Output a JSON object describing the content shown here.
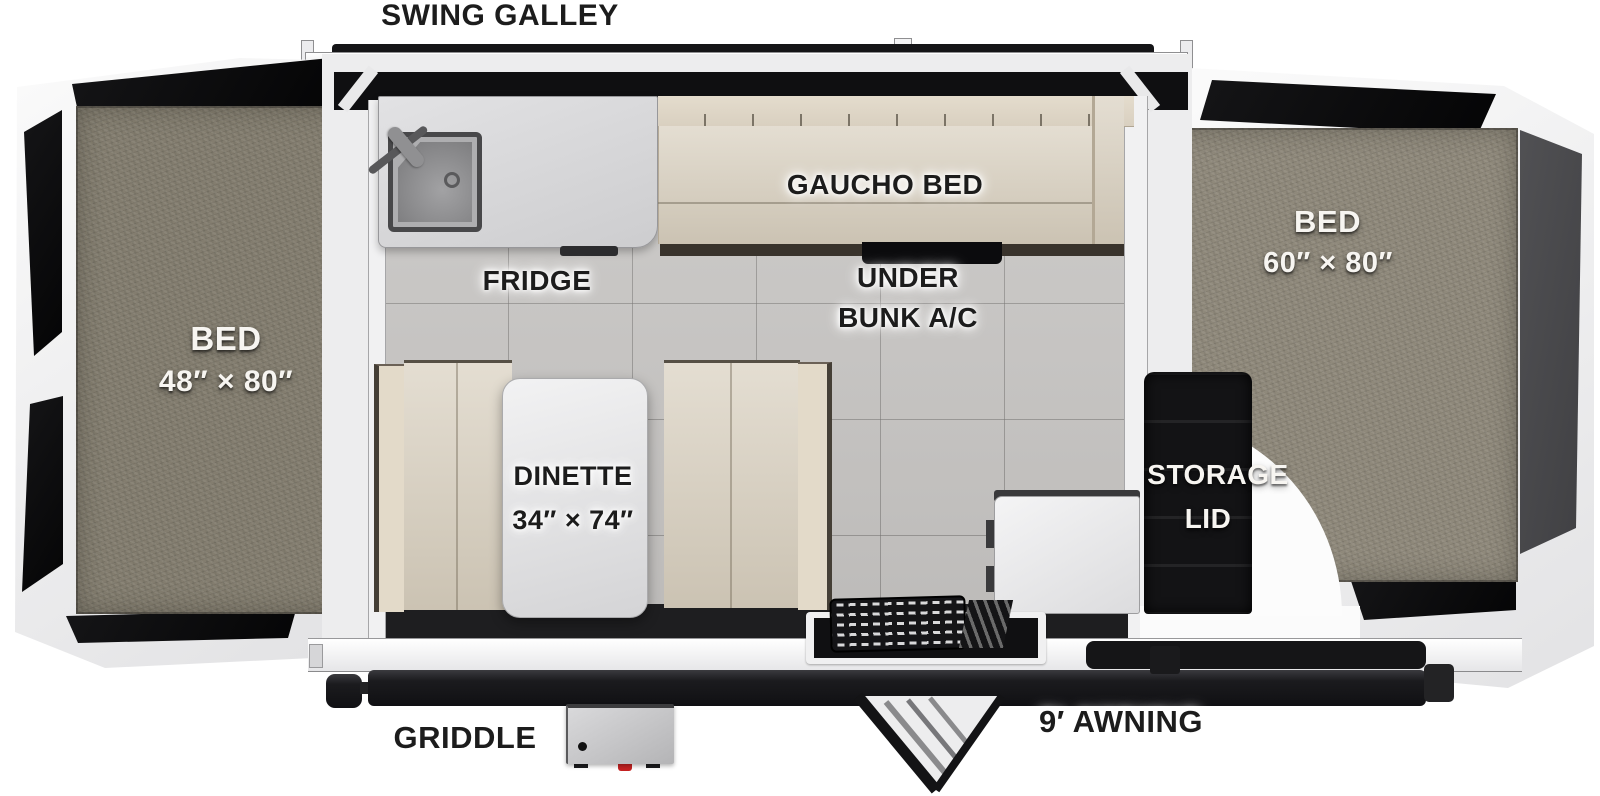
{
  "diagram_title": "SWING GALLEY",
  "labels": {
    "swing_galley": "SWING GALLEY",
    "left_bed": {
      "name": "BED",
      "size": "48″ × 80″"
    },
    "right_bed": {
      "name": "BED",
      "size": "60″ × 80″"
    },
    "gaucho_bed": "GAUCHO BED",
    "fridge": "FRIDGE",
    "under_bunk_ac": {
      "line1": "UNDER",
      "line2": "BUNK A/C"
    },
    "dinette": {
      "name": "DINETTE",
      "size": "34″ × 74″"
    },
    "storage_lid": {
      "line1": "STORAGE",
      "line2": "LID"
    },
    "griddle": "GRIDDLE",
    "awning": "9′ AWNING"
  },
  "colors": {
    "label_dark": "#1c1c1c",
    "label_light": "#f7f5f1",
    "carpet_left": "#837d6f",
    "carpet_right": "#8f897b",
    "cushion_beige": "#d8cfbe",
    "tile_floor": "#c8c6c4",
    "shell_white": "#f3f3f3",
    "canvas_black": "#0d0d0f",
    "storage_black": "#131315",
    "counter_gray": "#d6d6d8",
    "griddle_valve_red": "#c52222"
  }
}
